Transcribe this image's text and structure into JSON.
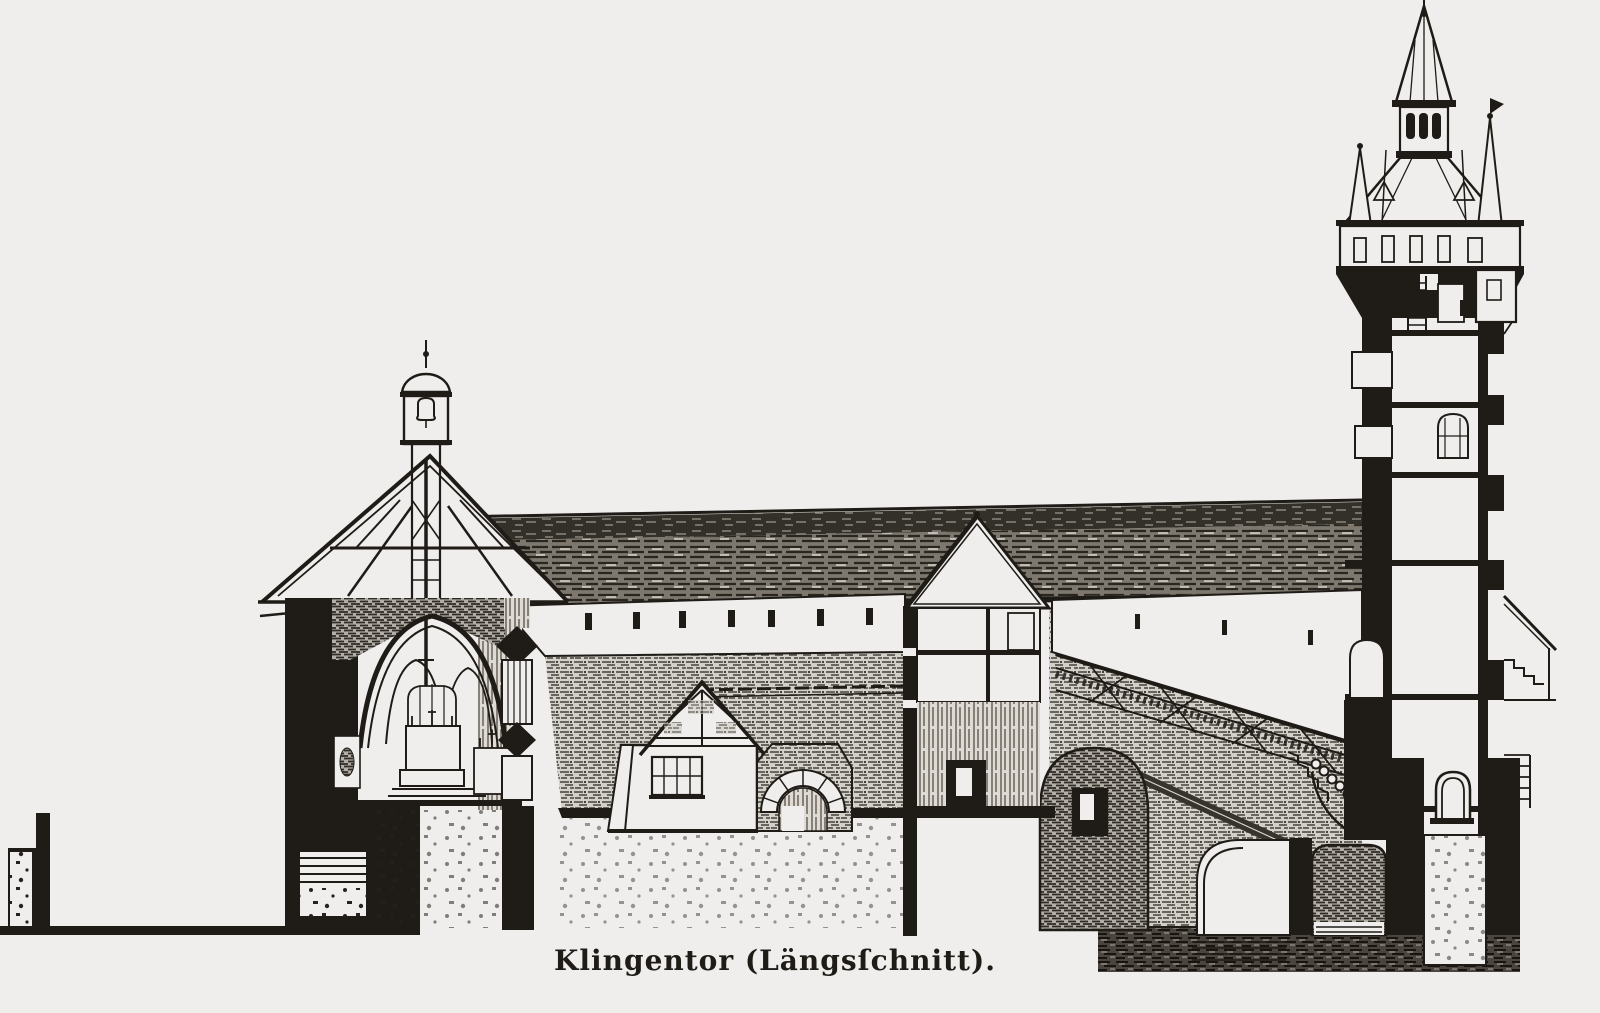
{
  "figure": {
    "caption": "Klingentor (Längsſchnitt).",
    "alt": "Antique engraving: longitudinal section through the Klingentor gate complex — chapel with ridge turret at left, covered wall-walk, courtyard house with portal arch, gatehouse, stair ramp and tall gate tower with spire at right"
  },
  "colors": {
    "paper": "#efeeec",
    "ink": "#1f1b17"
  }
}
